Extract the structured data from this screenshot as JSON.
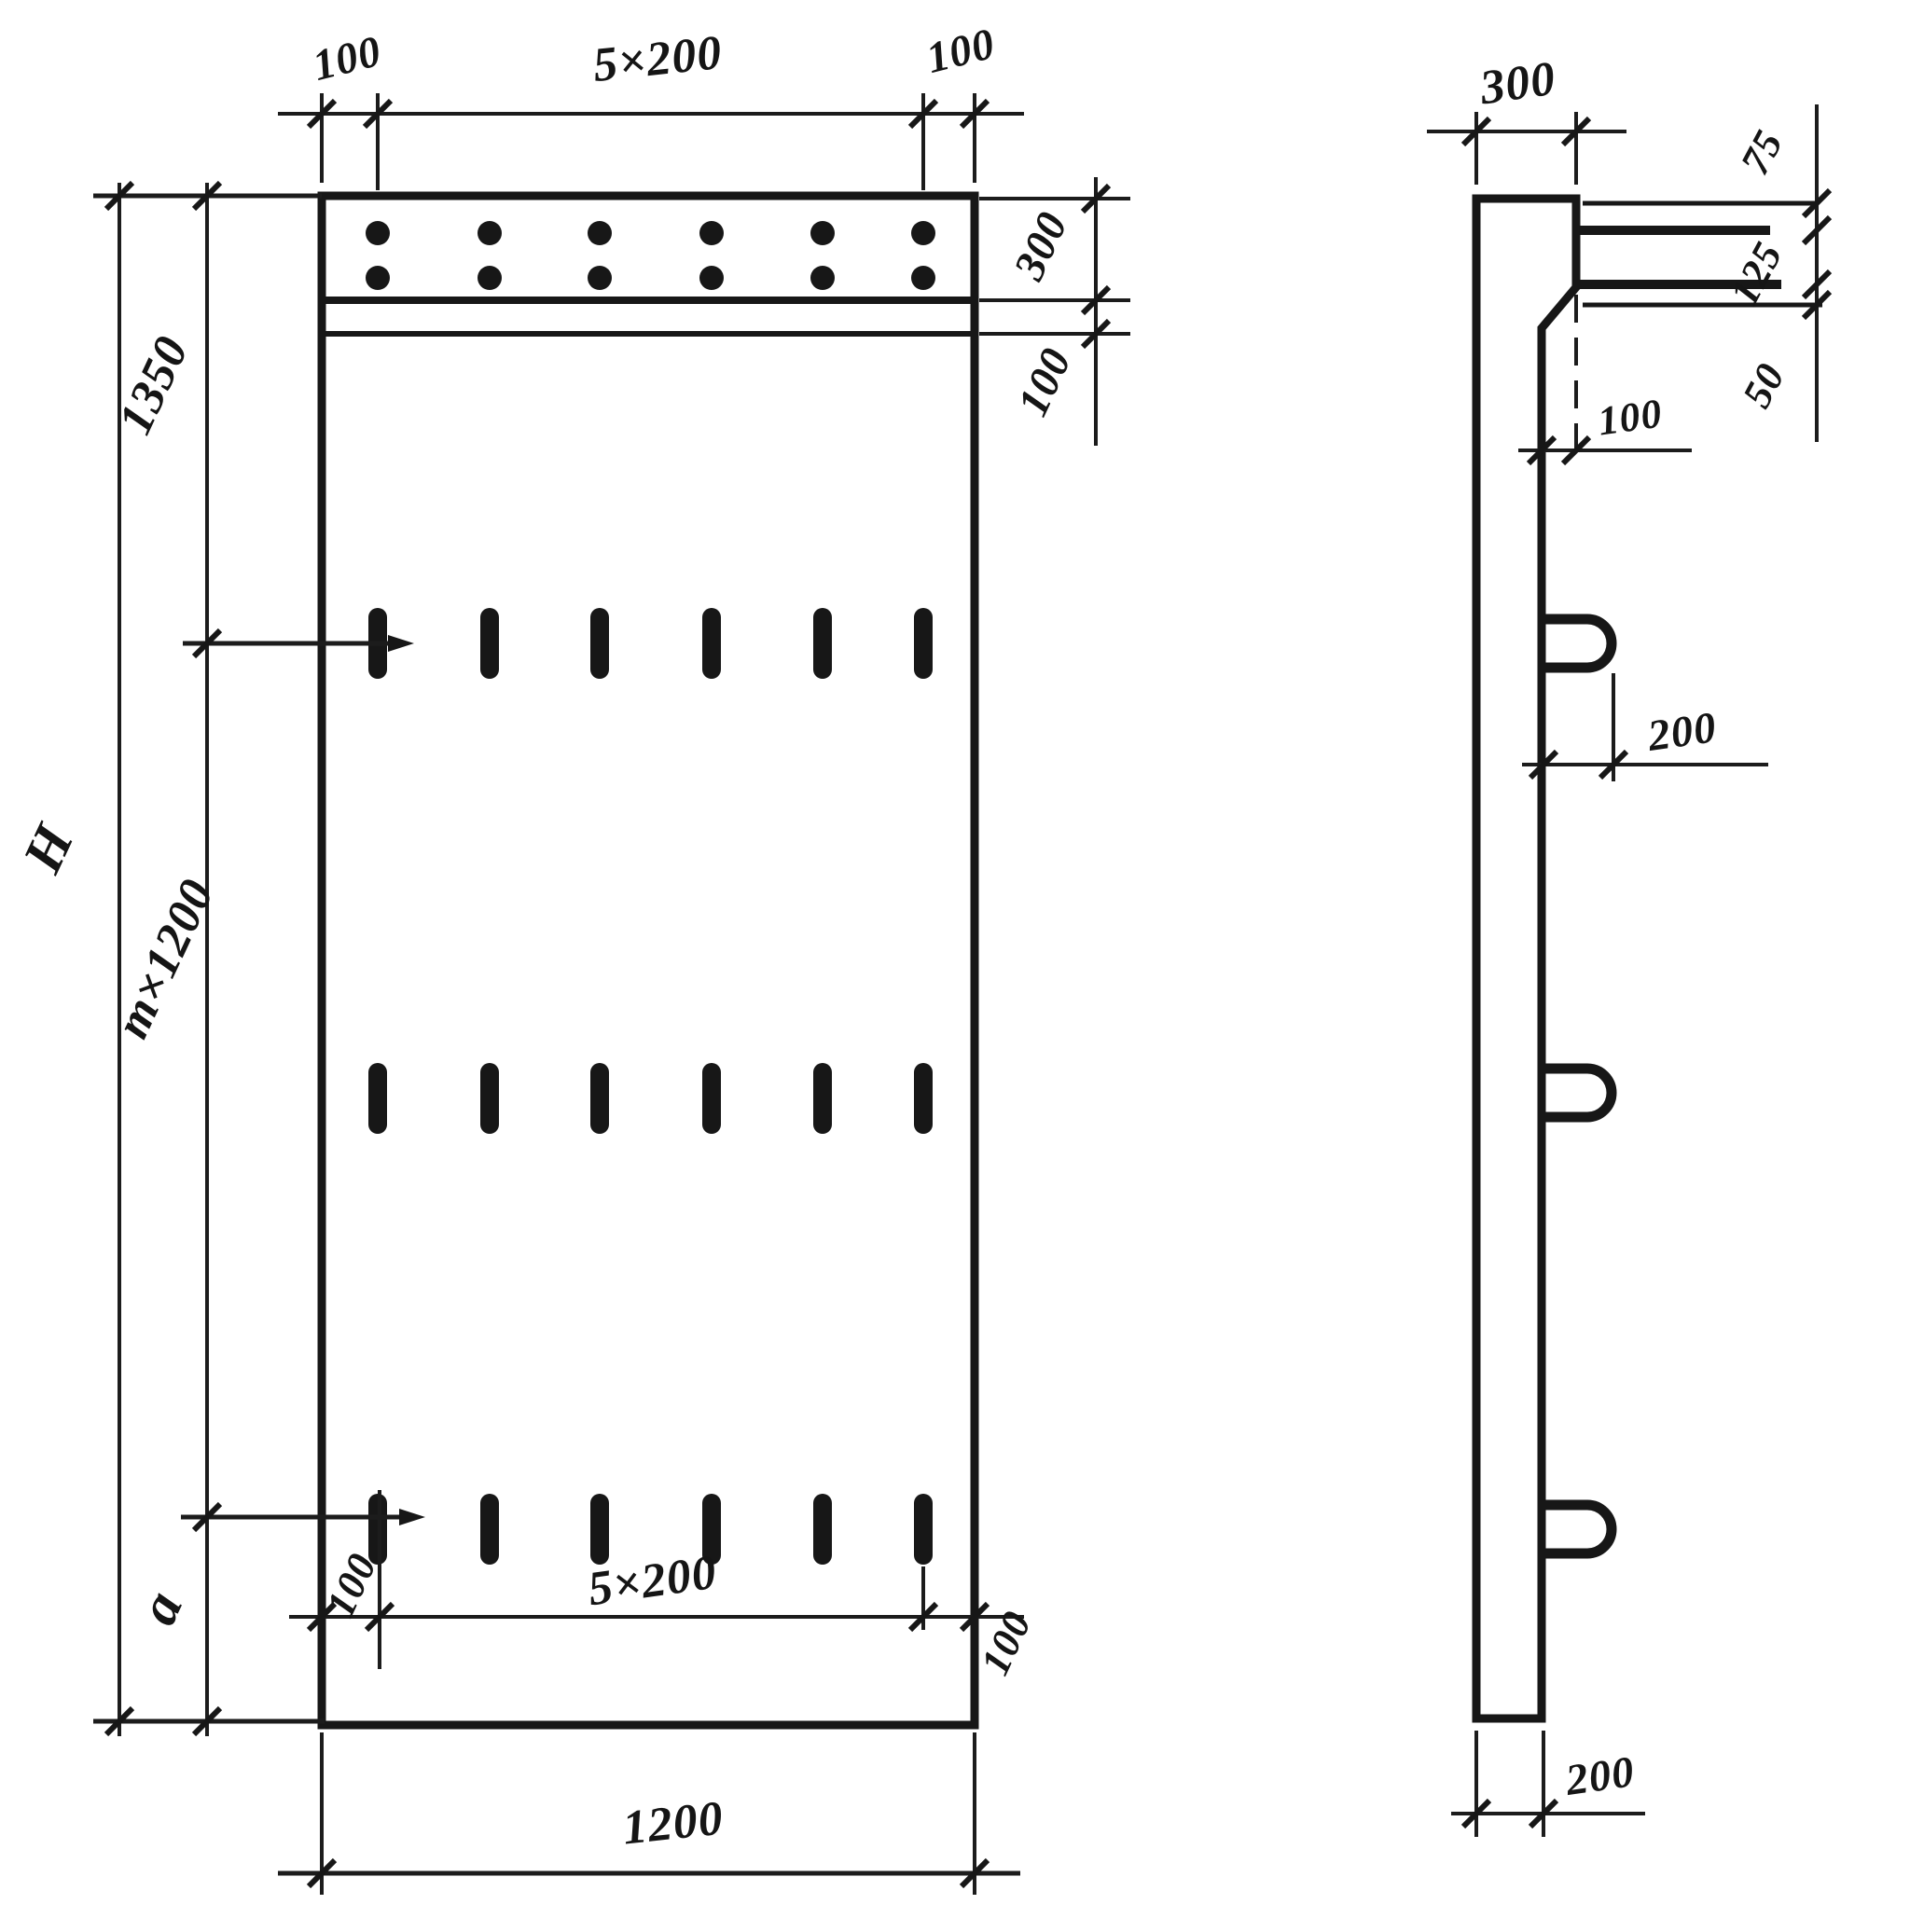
{
  "title": "Reinforced concrete wall panel — shop drawing (front view and side section)",
  "colors": {
    "ink": "#171717",
    "paper": "#ffffff"
  },
  "front": {
    "top": {
      "left_margin": "100",
      "spacing": "5×200",
      "right_margin": "100"
    },
    "right": {
      "band_height": "300",
      "gap": "100"
    },
    "left": {
      "top_segment": "1350",
      "middle_segment": "m×1200",
      "bottom_segment": "a",
      "overall_height": "H"
    },
    "bottom": {
      "left_margin": "100",
      "spacing": "5×200",
      "right_margin": "100",
      "overall_width": "1200"
    }
  },
  "side": {
    "top_width": "300",
    "bar_chain": {
      "first": "75",
      "second": "125",
      "third": "50"
    },
    "ledge_offset": "100",
    "loop_projection": "200",
    "wall_thickness": "200"
  }
}
